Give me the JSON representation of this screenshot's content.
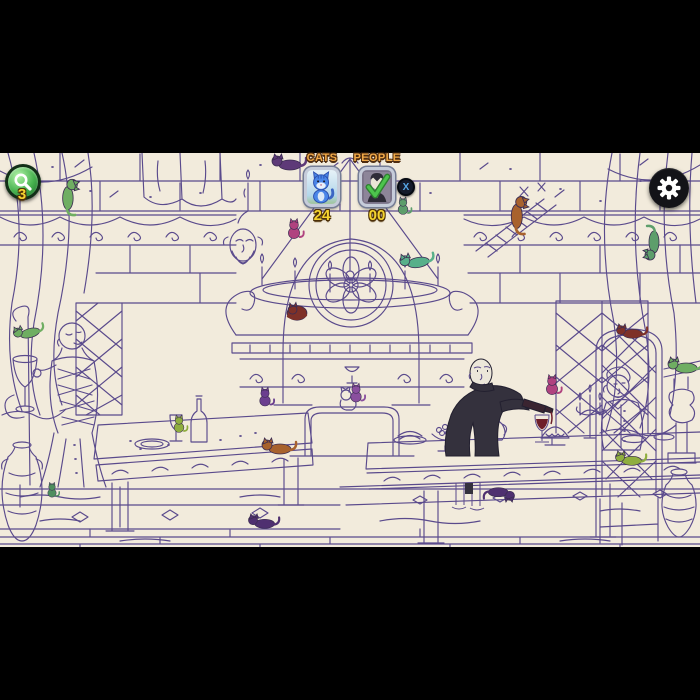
{
  "hud": {
    "hint_button": {
      "icon": "magnifier-icon",
      "count": "3"
    },
    "cats_counter": {
      "label": "CATS",
      "value": "24",
      "icon": "blue-cat-icon"
    },
    "people_counter": {
      "label": "PEOPLE",
      "value": "00",
      "icon": "vampire-portrait-icon",
      "status_icon": "green-check-icon"
    },
    "people_dismiss_button": {
      "label": "X"
    },
    "settings_button": {
      "icon": "gear-icon"
    },
    "colors": {
      "accent_yellow": "#f6d42f",
      "label_orange": "#f0a948",
      "hint_green": "#46b24e",
      "badge_frame": "#c6ccda"
    }
  },
  "scene": {
    "description": "Hand-drawn purple line-art of a gothic banquet hall: stone walls, chandelier, rose window above an ornate fireplace, long tables with food and wine, a vampire pouring wine, seated figures, curtains, lattice windows and hidden colored cats.",
    "colors": {
      "letterbox": "#000000",
      "background": "#f2ebdc",
      "linework": "#5a4a8c",
      "vampire_coat": "#34313d",
      "wine": "#6e1f2a"
    },
    "cats_hidden": [
      {
        "color": "#6fae62",
        "pose": "lie",
        "x": 70,
        "y": 42,
        "rot": 90,
        "s": 1.05
      },
      {
        "color": "#5e3a78",
        "pose": "lie",
        "x": 287,
        "y": 10,
        "rot": 0,
        "s": 1
      },
      {
        "color": "#b0427f",
        "pose": "sit",
        "x": 294,
        "y": 76,
        "rot": 0,
        "s": 0.8
      },
      {
        "color": "#a8622d",
        "pose": "lie",
        "x": 519,
        "y": 60,
        "rot": 90,
        "s": 1.1
      },
      {
        "color": "#5d9e6b",
        "pose": "lie",
        "x": 652,
        "y": 92,
        "rot": -90,
        "s": 1
      },
      {
        "color": "#5d9e6b",
        "pose": "sit",
        "x": 403,
        "y": 53,
        "rot": 0,
        "s": 0.7
      },
      {
        "color": "#57b08a",
        "pose": "lie",
        "x": 415,
        "y": 108,
        "rot": -10,
        "s": 1
      },
      {
        "color": "#7e3128",
        "pose": "curl",
        "x": 297,
        "y": 160,
        "rot": 0,
        "s": 1.1
      },
      {
        "color": "#8a4f9e",
        "pose": "sit",
        "x": 356,
        "y": 240,
        "rot": 0,
        "s": 0.75
      },
      {
        "color": "#6b3f8f",
        "pose": "sit",
        "x": 265,
        "y": 244,
        "rot": 0,
        "s": 0.75
      },
      {
        "color": "#8fae3f",
        "pose": "sit",
        "x": 179,
        "y": 271,
        "rot": 0,
        "s": 0.7
      },
      {
        "color": "#a8622d",
        "pose": "lie",
        "x": 277,
        "y": 294,
        "rot": 0,
        "s": 1
      },
      {
        "color": "#4f3070",
        "pose": "lie",
        "x": 262,
        "y": 369,
        "rot": 0,
        "s": 0.9
      },
      {
        "color": "#7e3128",
        "pose": "lie",
        "x": 630,
        "y": 179,
        "rot": 0,
        "s": 0.9
      },
      {
        "color": "#b0427f",
        "pose": "sit",
        "x": 552,
        "y": 232,
        "rot": 0,
        "s": 0.8
      },
      {
        "color": "#6fae62",
        "pose": "lie",
        "x": 683,
        "y": 213,
        "rot": 0,
        "s": 1
      },
      {
        "color": "#8fae3f",
        "pose": "lie",
        "x": 629,
        "y": 306,
        "rot": 0,
        "s": 0.9
      },
      {
        "color": "#4f3070",
        "pose": "lie",
        "x": 501,
        "y": 341,
        "rot": 180,
        "s": 0.9
      },
      {
        "color": "#6fae62",
        "pose": "lie",
        "x": 27,
        "y": 179,
        "rot": -15,
        "s": 0.9
      },
      {
        "color": "#4e8f5e",
        "pose": "sit",
        "x": 52,
        "y": 337,
        "rot": 0,
        "s": 0.6
      }
    ]
  }
}
